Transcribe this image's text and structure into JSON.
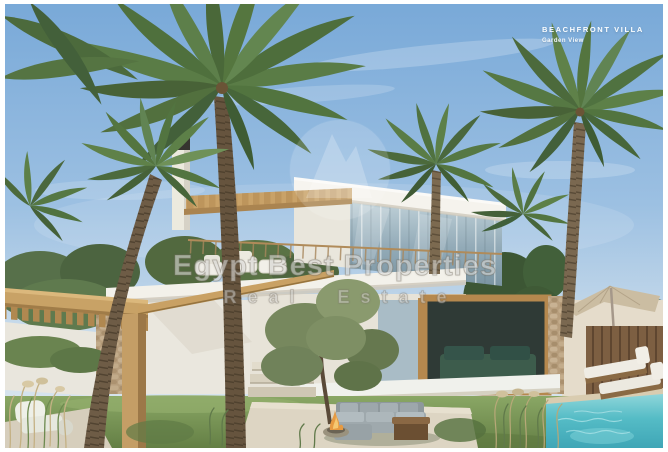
{
  "overlay": {
    "title": "BEACHFRONT VILLA",
    "subtitle": "Garden View"
  },
  "watermark": {
    "line1": "Egypt Best Properties",
    "line2": "Real Estate",
    "logo": "mountain-circle-logo"
  },
  "scene": {
    "description": "Architectural rendering of a modern two-storey white beachfront villa with glass facade, rooftop terrace with white sofas, wood pergolas, chimney, tall palm trees, olive trees, lawn garden, grey outdoor sectional sofa with fire pit, white lounge chair, shade parasol, and a turquoise swimming pool with two sun loungers.",
    "elements": [
      "palm-trees",
      "villa",
      "rooftop-terrace",
      "pergola",
      "chimney",
      "olive-tree",
      "lawn",
      "outdoor-sofa",
      "fire-pit",
      "coffee-table",
      "lounge-chair",
      "parasol",
      "wood-fence",
      "swimming-pool",
      "sun-loungers",
      "stone-wall",
      "garden-steps"
    ],
    "colors": {
      "sky_top": "#79a9d8",
      "sky_horizon": "#dde8ef",
      "villa_white": "#f3f1ea",
      "glass": "#93abb8",
      "pergola_wood": "#c8a266",
      "palm_green": "#537540",
      "olive_green": "#7a8a60",
      "grass": "#7d9b5a",
      "pool_water": "#4fb9c6",
      "stone": "#b79e7d",
      "frame_border": "#ffffff"
    }
  }
}
